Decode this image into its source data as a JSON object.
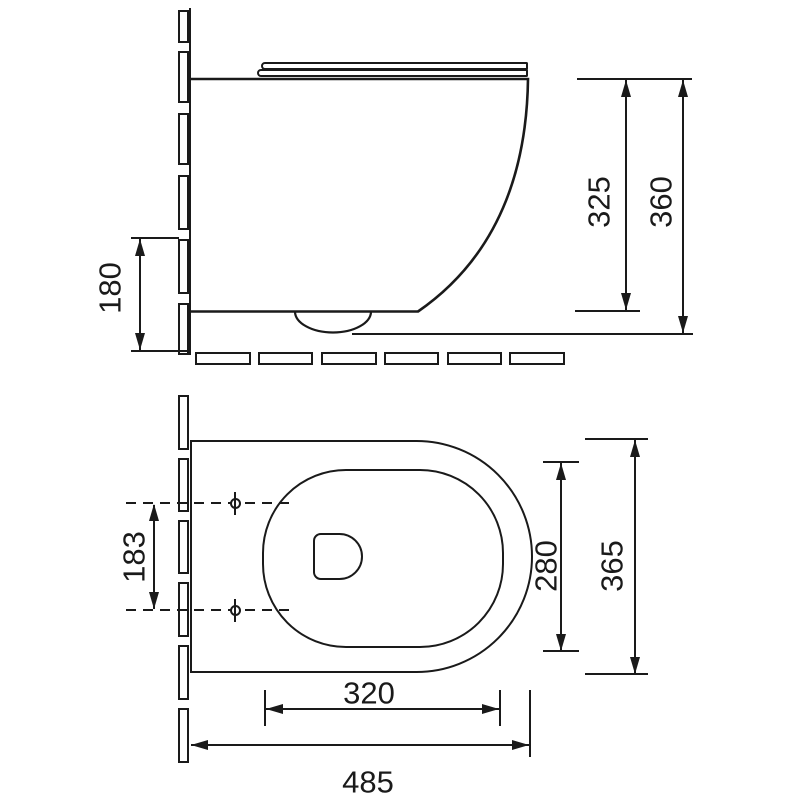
{
  "drawing": {
    "background": "#ffffff",
    "line_color": "#1a1a1a",
    "side_view": {
      "labels": {
        "outlet_height": "180",
        "rim_height": "325",
        "overall_height": "360"
      }
    },
    "plan_view": {
      "labels": {
        "fixing_centres": "183",
        "bowl_width": "280",
        "overall_width": "365",
        "bowl_depth": "320",
        "overall_depth": "485"
      }
    }
  }
}
